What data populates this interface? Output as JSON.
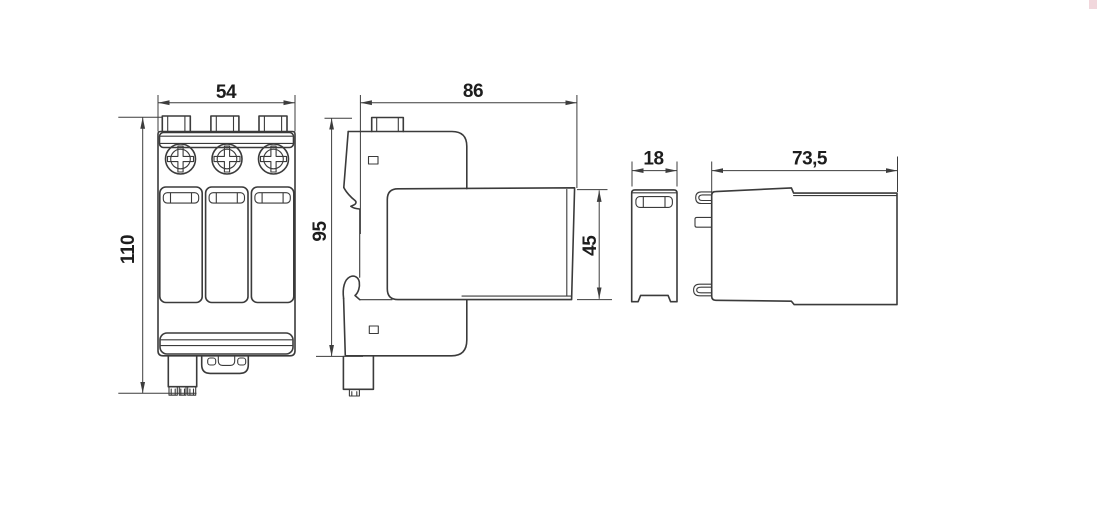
{
  "drawing": {
    "type": "technical-dimension-drawing",
    "subject": "surge-protection-device-3-pole-with-plug-in-module",
    "line_color": "#3b3b3b",
    "background": "#ffffff",
    "dimensions": {
      "front_width": "54",
      "front_height": "110",
      "base_depth": "86",
      "base_height": "95",
      "module_height": "45",
      "module_width": "18",
      "module_depth": "73,5"
    }
  }
}
